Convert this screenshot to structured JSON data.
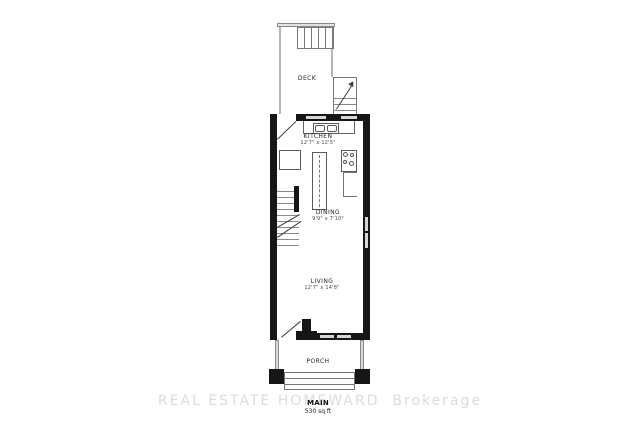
{
  "floorplan": {
    "floor_label": "MAIN",
    "area_label": "530 sq ft",
    "watermark": "REAL ESTATE HOMEWARD  Brokerage",
    "rooms": {
      "deck": {
        "name": "DECK"
      },
      "kitchen": {
        "name": "KITCHEN",
        "dimensions": "12'7\" x 12'5\""
      },
      "dining": {
        "name": "DINING",
        "dimensions": "9'9\" x 7'10\""
      },
      "living": {
        "name": "LIVING",
        "dimensions": "12'7\" x 14'8\""
      },
      "porch": {
        "name": "PORCH"
      }
    },
    "fixtures": [
      "double-sink",
      "island",
      "stove",
      "refrigerator",
      "counter",
      "staircase",
      "deck-stairs",
      "porch-steps",
      "entry-door",
      "windows"
    ],
    "colors": {
      "wall": "#161616",
      "railing": "#b4b4b4",
      "window": "#d6d6d6",
      "watermark": "#dcdcdc"
    }
  }
}
